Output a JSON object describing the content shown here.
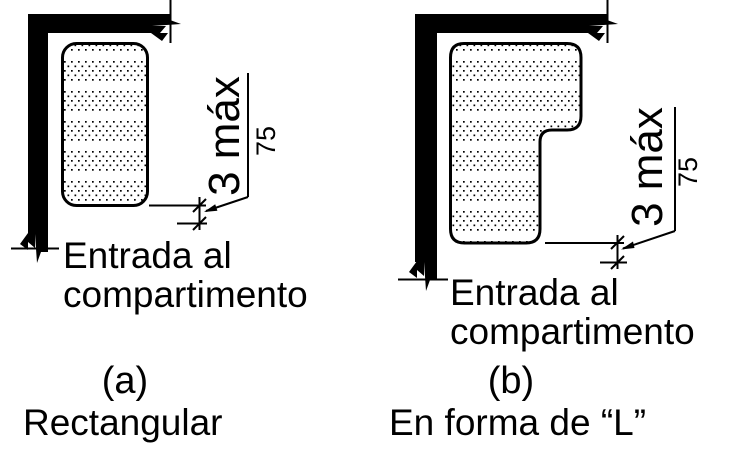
{
  "figure": {
    "colors": {
      "ink": "#000000",
      "background": "#ffffff"
    },
    "panels": [
      {
        "id": "a",
        "index_label": "(a)",
        "caption": "Rectangular",
        "entry_label": "Entrada al\ncompartimento",
        "dimension": {
          "primary": "3 máx",
          "secondary": "75"
        }
      },
      {
        "id": "b",
        "index_label": "(b)",
        "caption": "En forma de “L”",
        "entry_label": "Entrada al\ncompartimento",
        "dimension": {
          "primary": "3 máx",
          "secondary": "75"
        }
      }
    ]
  }
}
